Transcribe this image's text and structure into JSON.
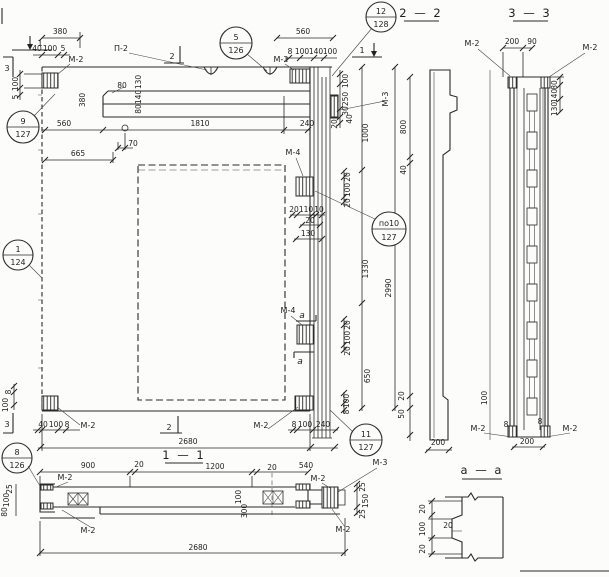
{
  "sections": {
    "s11": "1 — 1",
    "s22": "2 — 2",
    "s33": "3 — 3",
    "saa": "а — а"
  },
  "callouts": {
    "c9": {
      "num": "9",
      "ref": "127"
    },
    "c5": {
      "num": "5",
      "ref": "126"
    },
    "c12": {
      "num": "12",
      "ref": "128"
    },
    "c1": {
      "num": "1",
      "ref": "124"
    },
    "c10": {
      "num": "по10",
      "ref": "127"
    },
    "c8": {
      "num": "8",
      "ref": "126"
    },
    "c11": {
      "num": "11",
      "ref": "127"
    }
  },
  "marks": {
    "m2": "М-2",
    "m3": "М-3",
    "m4": "М-4",
    "p2": "П-2"
  },
  "cuts": {
    "c1": "1",
    "c2": "2",
    "c3": "3",
    "ca": "а"
  },
  "dims": {
    "top_left": {
      "w380": "380",
      "c40": "40",
      "c100": "100",
      "c5": "5",
      "v100": "100",
      "v5": "5"
    },
    "top_mid": {
      "w560": "560",
      "c8": "8",
      "c100a": "100",
      "c140": "140",
      "c100b": "100"
    },
    "band": {
      "ch80": "80",
      "v130": "130",
      "v140": "140",
      "v80": "80",
      "h380": "380",
      "s560": "560",
      "s1810": "1810",
      "s240": "240",
      "o70": "70",
      "e665": "665"
    },
    "right_top": {
      "a100": "100",
      "a250": "250",
      "a30": "30",
      "a40": "40",
      "a20": "20",
      "t1000": "1000"
    },
    "s22side": {
      "d800": "800",
      "d40": "40",
      "d20": "20",
      "d50": "50",
      "base200": "200"
    },
    "rib": {
      "a20": "20",
      "b110": "110",
      "c10": "10",
      "d20": "20",
      "e130": "130"
    },
    "anch_u": {
      "a": "20",
      "b": "100",
      "c": "20"
    },
    "anch_l": {
      "a": "20",
      "b": "100",
      "c": "20"
    },
    "right_mid": {
      "d1330": "1330",
      "d650": "650",
      "h2990": "2990"
    },
    "bot_left": {
      "v8": "8",
      "v100": "100",
      "c40": "40",
      "c100": "100",
      "c8": "8"
    },
    "bot_right": {
      "c8": "8",
      "c100": "100",
      "c240": "240",
      "v100": "100",
      "v8": "8"
    },
    "bot": {
      "w2680": "2680"
    },
    "s33": {
      "t200": "200",
      "t90": "90",
      "r80": "80",
      "r140": "140",
      "r130": "130",
      "l100": "100",
      "b200": "200",
      "b8l": "8",
      "b8r": "8"
    },
    "s11": {
      "d900": "900",
      "d20a": "20",
      "d1200": "1200",
      "d20b": "20",
      "d540": "540",
      "w2680": "2680",
      "l25": "25",
      "l100": "100",
      "l80": "80",
      "m100": "100",
      "m300": "300",
      "r25a": "25",
      "r150": "150",
      "r25b": "25"
    },
    "saa": {
      "v20a": "20",
      "v100": "100",
      "v20b": "20",
      "depth20": "20"
    }
  }
}
